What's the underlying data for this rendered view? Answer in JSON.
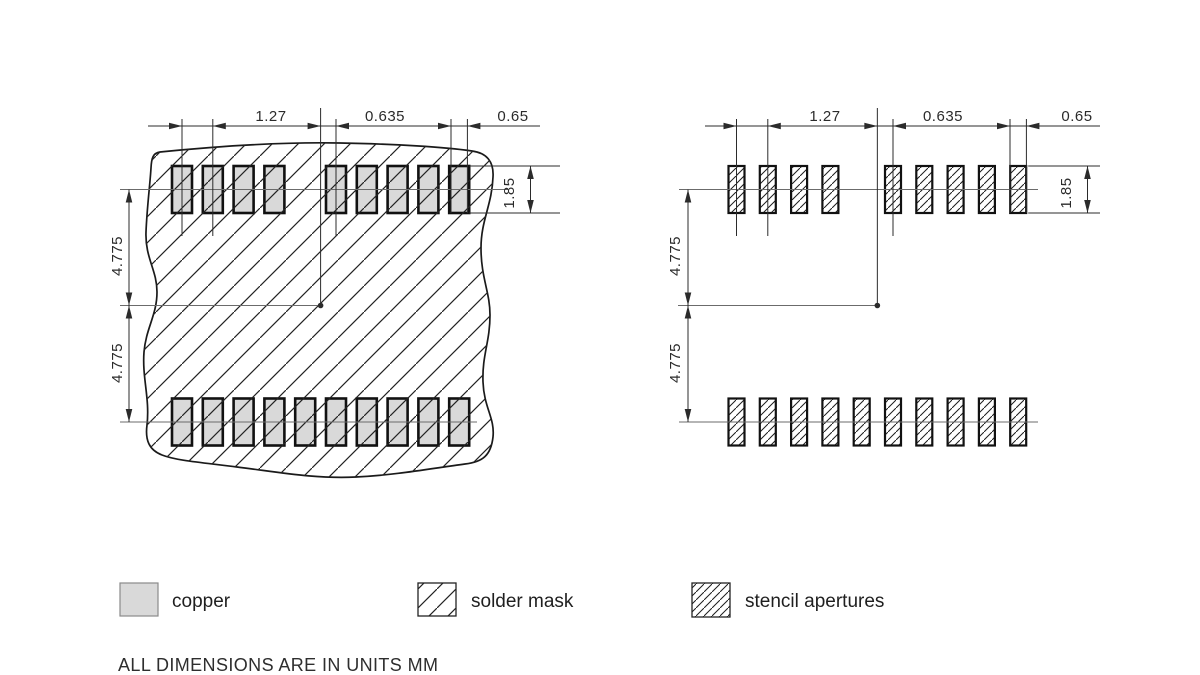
{
  "drawing": {
    "title_note": "ALL DIMENSIONS ARE IN UNITS MM",
    "units": "mm",
    "dims": {
      "pitch": "1.27",
      "half_pitch": "0.635",
      "pad_width": "0.65",
      "pad_height": "1.85",
      "center_to_row_upper": "4.775",
      "center_to_row_lower": "4.775"
    },
    "views": [
      {
        "id": "copper-and-solder-mask",
        "top_row_pad_count": 9,
        "bottom_row_pad_count": 10
      },
      {
        "id": "stencil-apertures",
        "top_row_pad_count": 9,
        "bottom_row_pad_count": 10
      }
    ],
    "legend": [
      {
        "label": "copper"
      },
      {
        "label": "solder mask"
      },
      {
        "label": "stencil apertures"
      }
    ],
    "colors": {
      "copper_fill": "#d9d9d9",
      "line": "#2b2b2b",
      "pad_border": "#111111",
      "centerline": "#6b6b6b",
      "background": "#ffffff"
    }
  }
}
